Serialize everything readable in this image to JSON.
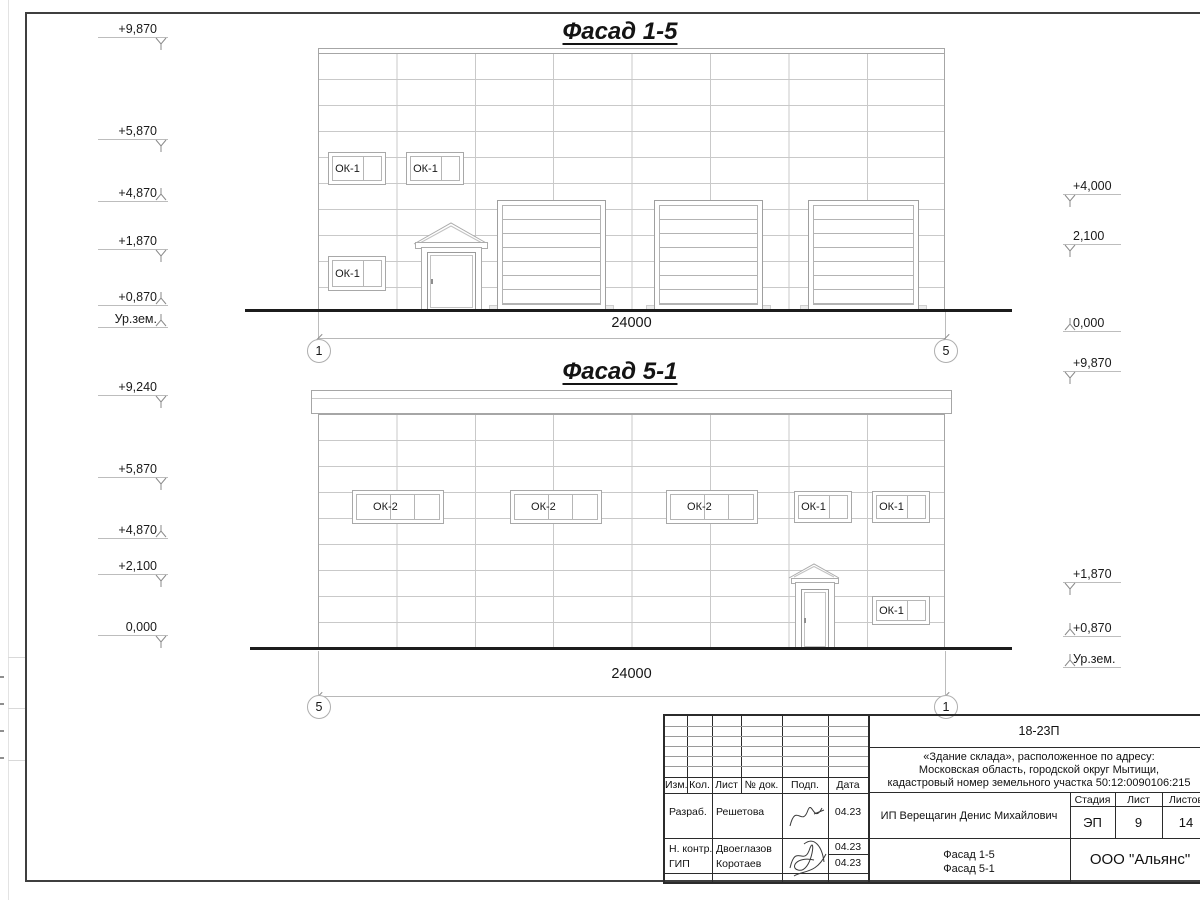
{
  "facade1": {
    "title": "Фасад 1-5",
    "dim": "24000",
    "axis_left": "1",
    "axis_right": "5",
    "windows": [
      "ОК-1",
      "ОК-1",
      "ОК-1"
    ],
    "marks_left": [
      {
        "label": "+9,870",
        "dir": "down"
      },
      {
        "label": "+5,870",
        "dir": "down"
      },
      {
        "label": "+4,870",
        "dir": "up"
      },
      {
        "label": "+1,870",
        "dir": "down"
      },
      {
        "label": "+0,870",
        "dir": "up"
      },
      {
        "label": "Ур.зем.",
        "dir": "up"
      }
    ],
    "marks_right": [
      {
        "label": "+4,000",
        "dir": "down"
      },
      {
        "label": "2,100",
        "dir": "down"
      },
      {
        "label": "0,000",
        "dir": "up"
      }
    ]
  },
  "facade2": {
    "title": "Фасад 5-1",
    "dim": "24000",
    "axis_left": "5",
    "axis_right": "1",
    "windows": [
      "ОК-2",
      "ОК-2",
      "ОК-2",
      "ОК-1",
      "ОК-1",
      "ОК-1"
    ],
    "marks_left": [
      {
        "label": "+9,240",
        "dir": "down"
      },
      {
        "label": "+5,870",
        "dir": "down"
      },
      {
        "label": "+4,870",
        "dir": "up"
      },
      {
        "label": "+2,100",
        "dir": "down"
      },
      {
        "label": "0,000",
        "dir": "down"
      }
    ],
    "marks_right": [
      {
        "label": "+9,870",
        "dir": "down"
      },
      {
        "label": "+1,870",
        "dir": "down"
      },
      {
        "label": "+0,870",
        "dir": "up"
      },
      {
        "label": "Ур.зем.",
        "dir": "up"
      }
    ]
  },
  "titleblock": {
    "code": "18-23П",
    "address_line1": "«Здание склада», расположенное по адресу:",
    "address_line2": "Московская область, городской округ Мытищи,",
    "address_line3": "кадастровый номер земельного участка 50:12:0090106:215",
    "client": "ИП Верещагин Денис Михайлович",
    "sheet_title_line1": "Фасад 1-5",
    "sheet_title_line2": "Фасад 5-1",
    "company": "ООО \"Альянс\"",
    "stage_label": "Стадия",
    "sheet_label": "Лист",
    "sheets_label": "Листов",
    "stage": "ЭП",
    "sheet": "9",
    "sheets": "14",
    "cols": {
      "izm": "Изм.",
      "kol": "Кол.",
      "list": "Лист",
      "doc": "№ док.",
      "podp": "Подп.",
      "data": "Дата"
    },
    "rows": [
      {
        "role": "Разраб.",
        "name": "Решетова",
        "date": "04.23"
      },
      {
        "role": "Н. контр.",
        "name": "Двоеглазов",
        "date": "04.23"
      },
      {
        "role": "ГИП",
        "name": "Коротаев",
        "date": "04.23"
      }
    ]
  }
}
